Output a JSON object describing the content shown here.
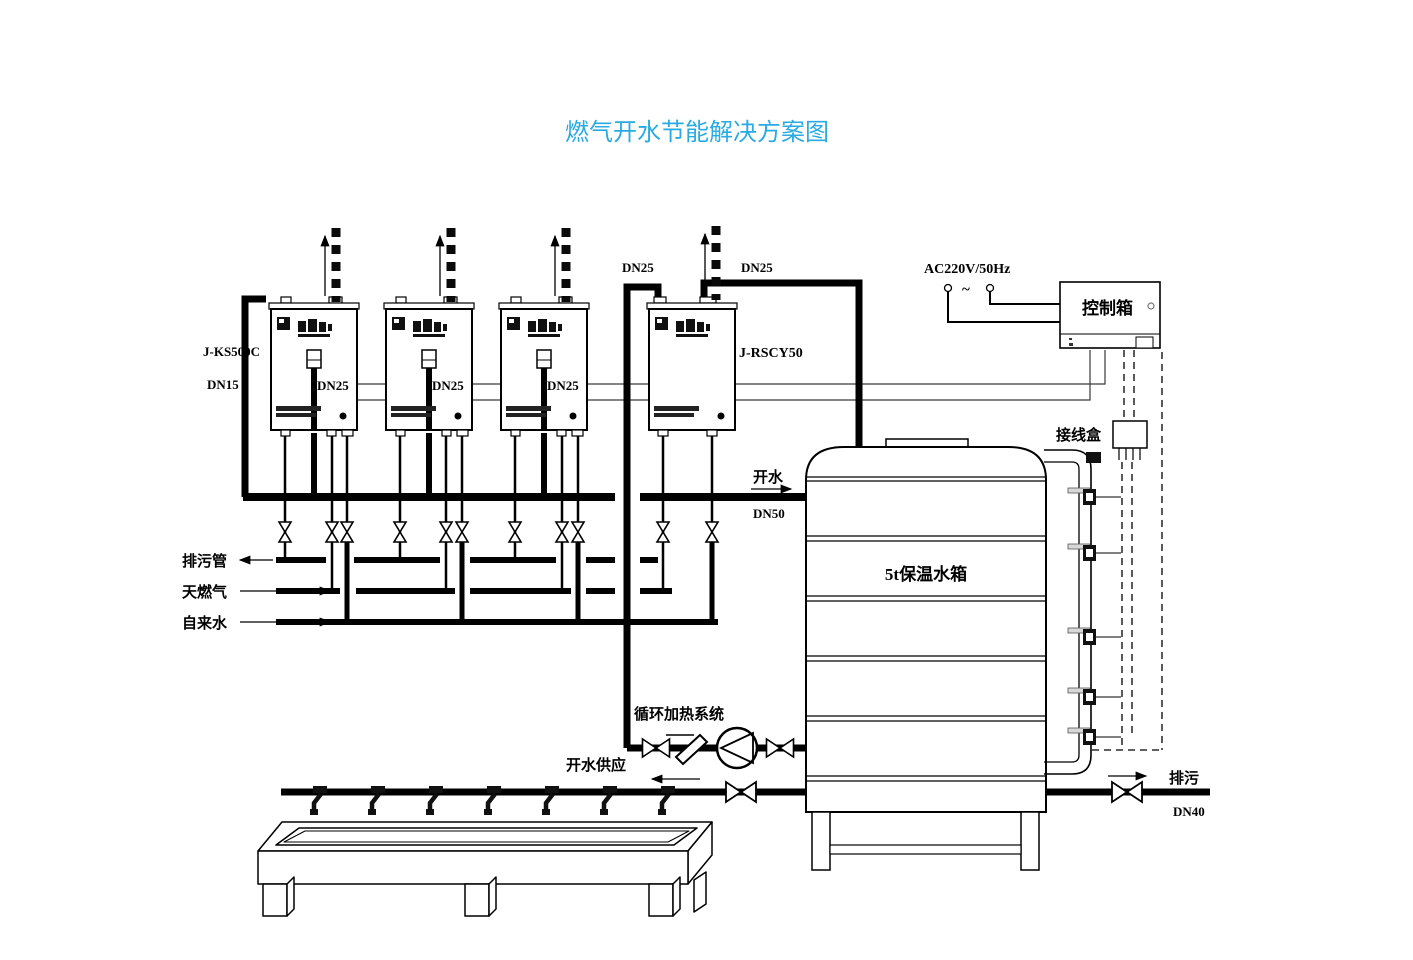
{
  "title": {
    "text": "燃气开水节能解决方案图",
    "color": "#29ABE2"
  },
  "heaters": {
    "model_label": "J-KS500C",
    "inlet_size": "DN15",
    "outlet_size": "DN25",
    "circulation_heater_model": "J-RSCY50"
  },
  "top_pipes": {
    "left_label": "DN25",
    "right_label": "DN25"
  },
  "power_supply": {
    "label": "AC220V/50Hz",
    "ac_symbol": "~"
  },
  "control_box": {
    "label": "控制箱"
  },
  "junction_box": {
    "label": "接线盒"
  },
  "storage_tank": {
    "label": "5t保温水箱"
  },
  "hot_water_outlet": {
    "label": "开水",
    "pipe_size": "DN50"
  },
  "service_lines": {
    "drain": "排污管",
    "gas": "天燃气",
    "tap_water": "自来水"
  },
  "circulation_system": {
    "label": "循环加热系统"
  },
  "hot_water_supply": {
    "label": "开水供应"
  },
  "blowdown": {
    "label": "排污",
    "pipe_size": "DN40"
  }
}
